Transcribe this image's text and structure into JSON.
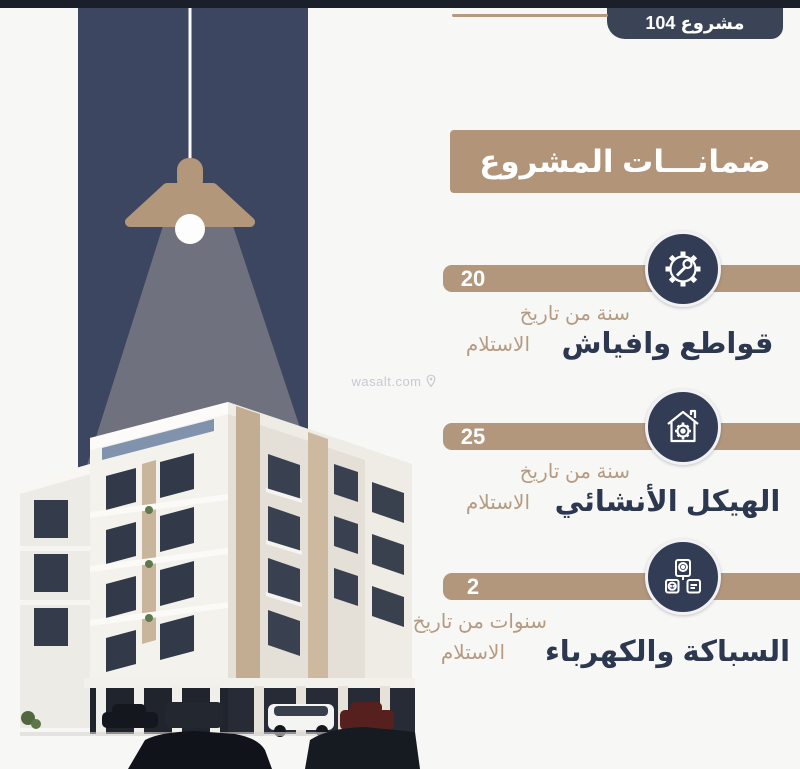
{
  "badge": {
    "label": "مشروع 104"
  },
  "title": "ضمانـــات المشروع",
  "watermark": {
    "text": "wasalt.com",
    "icon": "location-pin-icon"
  },
  "guarantees": [
    {
      "value": "20",
      "duration_line1": "سنة من تاريخ",
      "duration_line2": "الاستلام",
      "label": "قواطع وافياش",
      "icon": "gear-wrench-icon"
    },
    {
      "value": "25",
      "duration_line1": "سنة من تاريخ",
      "duration_line2": "الاستلام",
      "label": "الهيكل الأنشائي",
      "icon": "house-gear-icon"
    },
    {
      "value": "2",
      "duration_line1": "سنوات من تاريخ",
      "duration_line2": "الاستلام",
      "label": "السباكة والكهرباء",
      "icon": "appliances-plug-icon"
    }
  ],
  "colors": {
    "top_bar": "#1b1f2a",
    "navy_strip": "#3d4660",
    "badge_navy": "#3b4357",
    "icon_circle_navy": "#323c55",
    "label_navy": "#2c3850",
    "tan_accent": "#b2977c",
    "tan_title_box": "#b29478",
    "tan_text": "#b59b81",
    "beam_gray": "#6f727e"
  }
}
